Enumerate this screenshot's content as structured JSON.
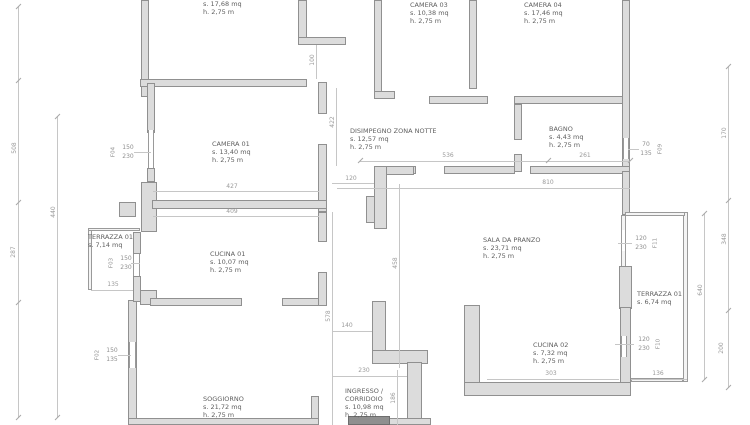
{
  "drawing": {
    "type": "floor plan"
  },
  "rooms": {
    "camera02": {
      "area": "s. 17,68 mq",
      "height": "h. 2,75 m"
    },
    "camera03": {
      "name": "CAMERA 03",
      "area": "s. 10,38 mq",
      "height": "h. 2,75 m"
    },
    "camera04": {
      "name": "CAMERA 04",
      "area": "s. 17,46 mq",
      "height": "h. 2,75 m"
    },
    "disimpegno": {
      "name": "DISIMPEGNO ZONA NOTTE",
      "area": "s. 12,57 mq",
      "height": "h. 2,75 m"
    },
    "bagno": {
      "name": "BAGNO",
      "area": "s. 4,43 mq",
      "height": "h. 2,75 m"
    },
    "camera01": {
      "name": "CAMERA 01",
      "area": "s. 13,40 mq",
      "height": "h. 2,75 m"
    },
    "terrazza01a": {
      "name": "TERRAZZA 01",
      "area": "s. 7,14 mq"
    },
    "cucina01": {
      "name": "CUCINA 01",
      "area": "s. 10,07 mq",
      "height": "h. 2,75 m"
    },
    "sala": {
      "name": "SALA DA PRANZO",
      "area": "s. 23,71 mq",
      "height": "h. 2,75 m"
    },
    "terrazza01b": {
      "name": "TERRAZZA 01",
      "area": "s. 6,74 mq"
    },
    "cucina02": {
      "name": "CUCINA 02",
      "area": "s. 7,32 mq",
      "height": "h. 2,75 m"
    },
    "soggiorno": {
      "name": "SOGGIORNO",
      "area": "s. 21,72 mq",
      "height": "h. 2,75 m"
    },
    "ingresso": {
      "name1": "INGRESSO /",
      "name2": "CORRIDOIO",
      "area": "s. 10,98 mq",
      "height": "h. 2,75 m"
    }
  },
  "windows": {
    "f04": {
      "code": "F04",
      "w": "150",
      "h": "230"
    },
    "f03": {
      "code": "F03",
      "w": "150",
      "h": "230"
    },
    "f02": {
      "code": "F02",
      "w": "150",
      "h": "135"
    },
    "f09": {
      "code": "F09",
      "w": "70",
      "h": "135"
    },
    "f11": {
      "code": "F11",
      "w": "120",
      "h": "230"
    },
    "f10": {
      "code": "F10",
      "w": "120",
      "h": "230"
    }
  },
  "dims": {
    "left_a": "508",
    "left_b": "287",
    "left_inner": "440",
    "gap_top": "100",
    "corr_a": "422",
    "corr_b": "458",
    "corr_c": "578",
    "corr_d": "186",
    "cam01_top": "427",
    "cam01_bot": "409",
    "door": "120",
    "top_mid": "536",
    "top_right": "261",
    "sala_w": "810",
    "right_a": "170",
    "right_b": "348",
    "right_c": "200",
    "right_inner": "640",
    "terr_sx": "135",
    "ing_a": "140",
    "ing_b": "230",
    "cuc02_w": "303",
    "terr_dx_w": "136"
  }
}
